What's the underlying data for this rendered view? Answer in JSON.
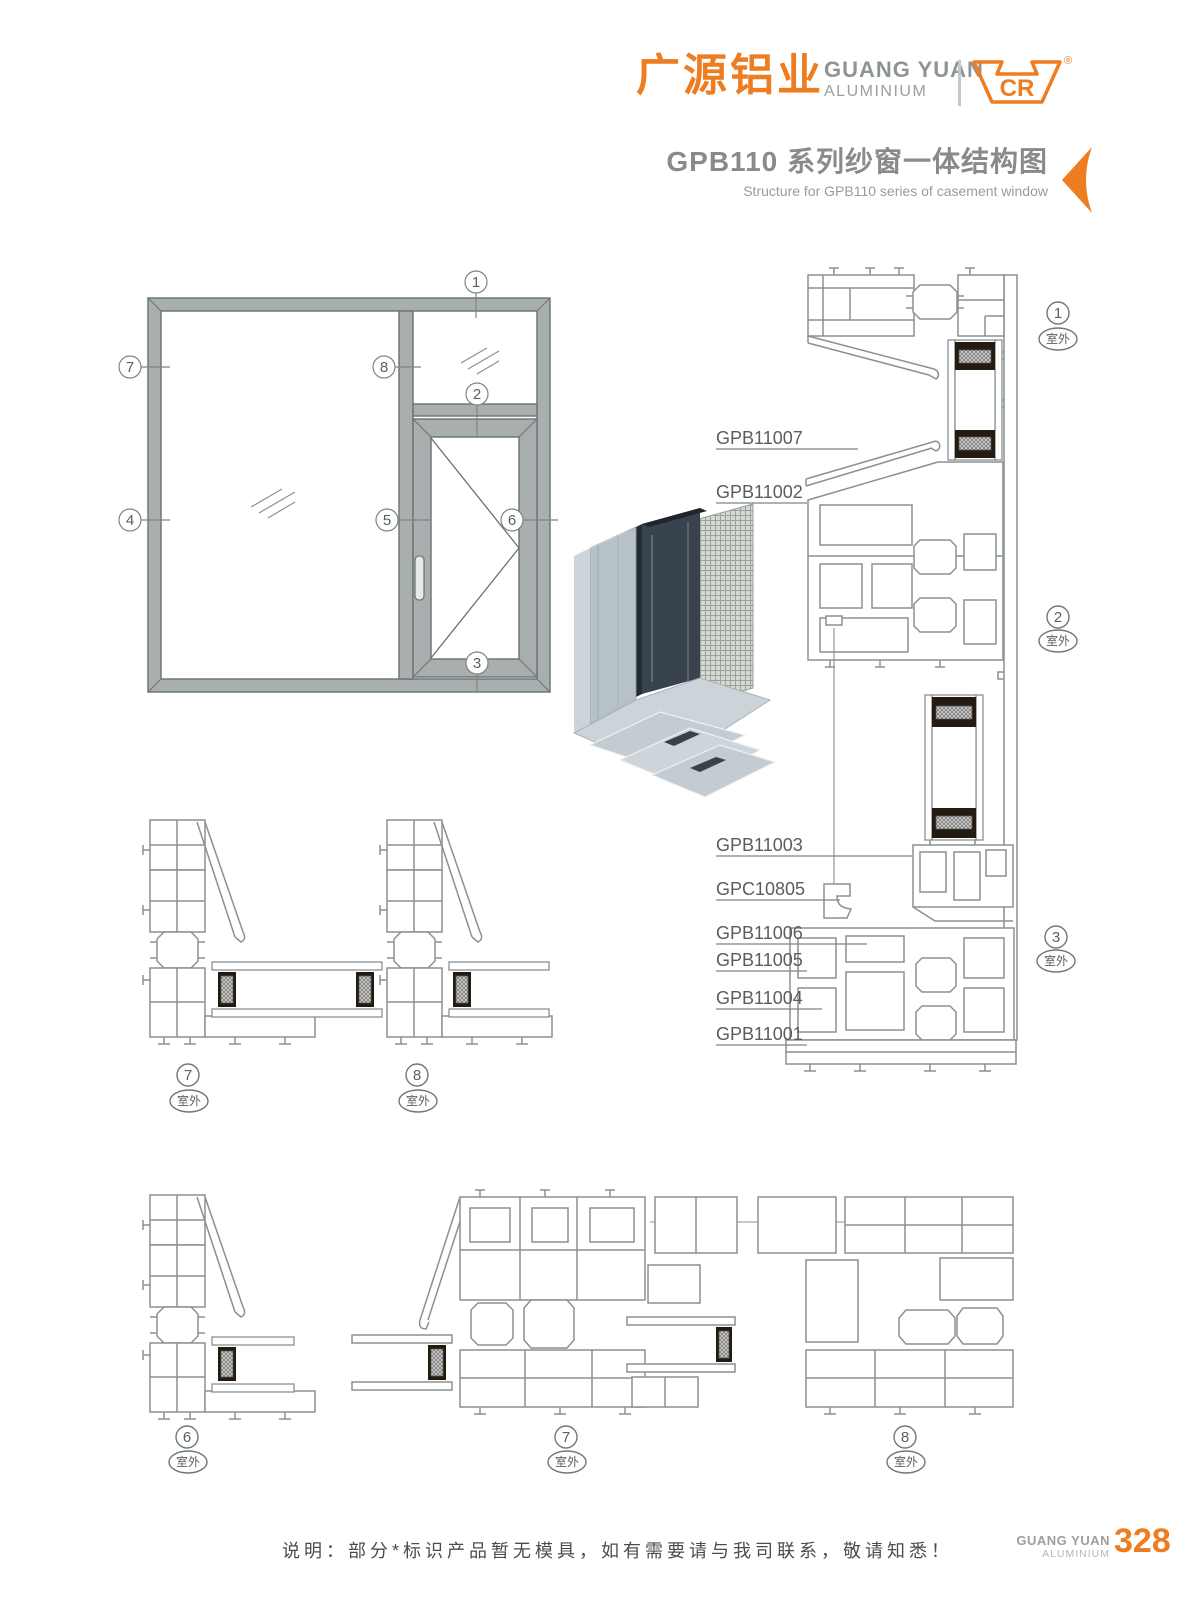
{
  "header": {
    "brand_cn": "广源铝业",
    "brand_en_line1": "GUANG YUAN",
    "brand_en_line2": "ALUMINIUM",
    "logo_text": "CR",
    "registered_mark": "®",
    "title": "GPB110 系列纱窗一体结构图",
    "subtitle": "Structure for GPB110 series of casement window"
  },
  "drawing": {
    "elevation_callouts": {
      "c1": "1",
      "c2": "2",
      "c3": "3",
      "c4": "4",
      "c5": "5",
      "c6": "6",
      "c7": "7",
      "c8": "8"
    },
    "profile_labels": {
      "l1": "GPB11007",
      "l2": "GPB11002",
      "l3": "GPB11003",
      "l4": "GPC10805",
      "l5": "GPB11006",
      "l6": "GPB11005",
      "l7": "GPB11004",
      "l8": "GPB11001"
    },
    "detail_sections": [
      {
        "num": "1",
        "loc": "室外"
      },
      {
        "num": "2",
        "loc": "室外"
      },
      {
        "num": "3",
        "loc": "室外"
      },
      {
        "num": "7",
        "loc": "室外"
      },
      {
        "num": "8",
        "loc": "室外"
      },
      {
        "num": "6",
        "loc": "室外"
      },
      {
        "num": "7",
        "loc": "室外"
      },
      {
        "num": "8",
        "loc": "室外"
      }
    ]
  },
  "footer": {
    "note": "说明：部分*标识产品暂无模具，如有需要请与我司联系，敬请知悉！",
    "brand_line1": "GUANG YUAN",
    "brand_line2": "ALUMINIUM",
    "page_number": "328"
  },
  "colors": {
    "accent": "#EE7C21",
    "title_gray": "#8A8A8A",
    "line_gray": "#8A9191",
    "frame_fill": "#A9AEAE",
    "spacer_dark": "#241B10"
  }
}
